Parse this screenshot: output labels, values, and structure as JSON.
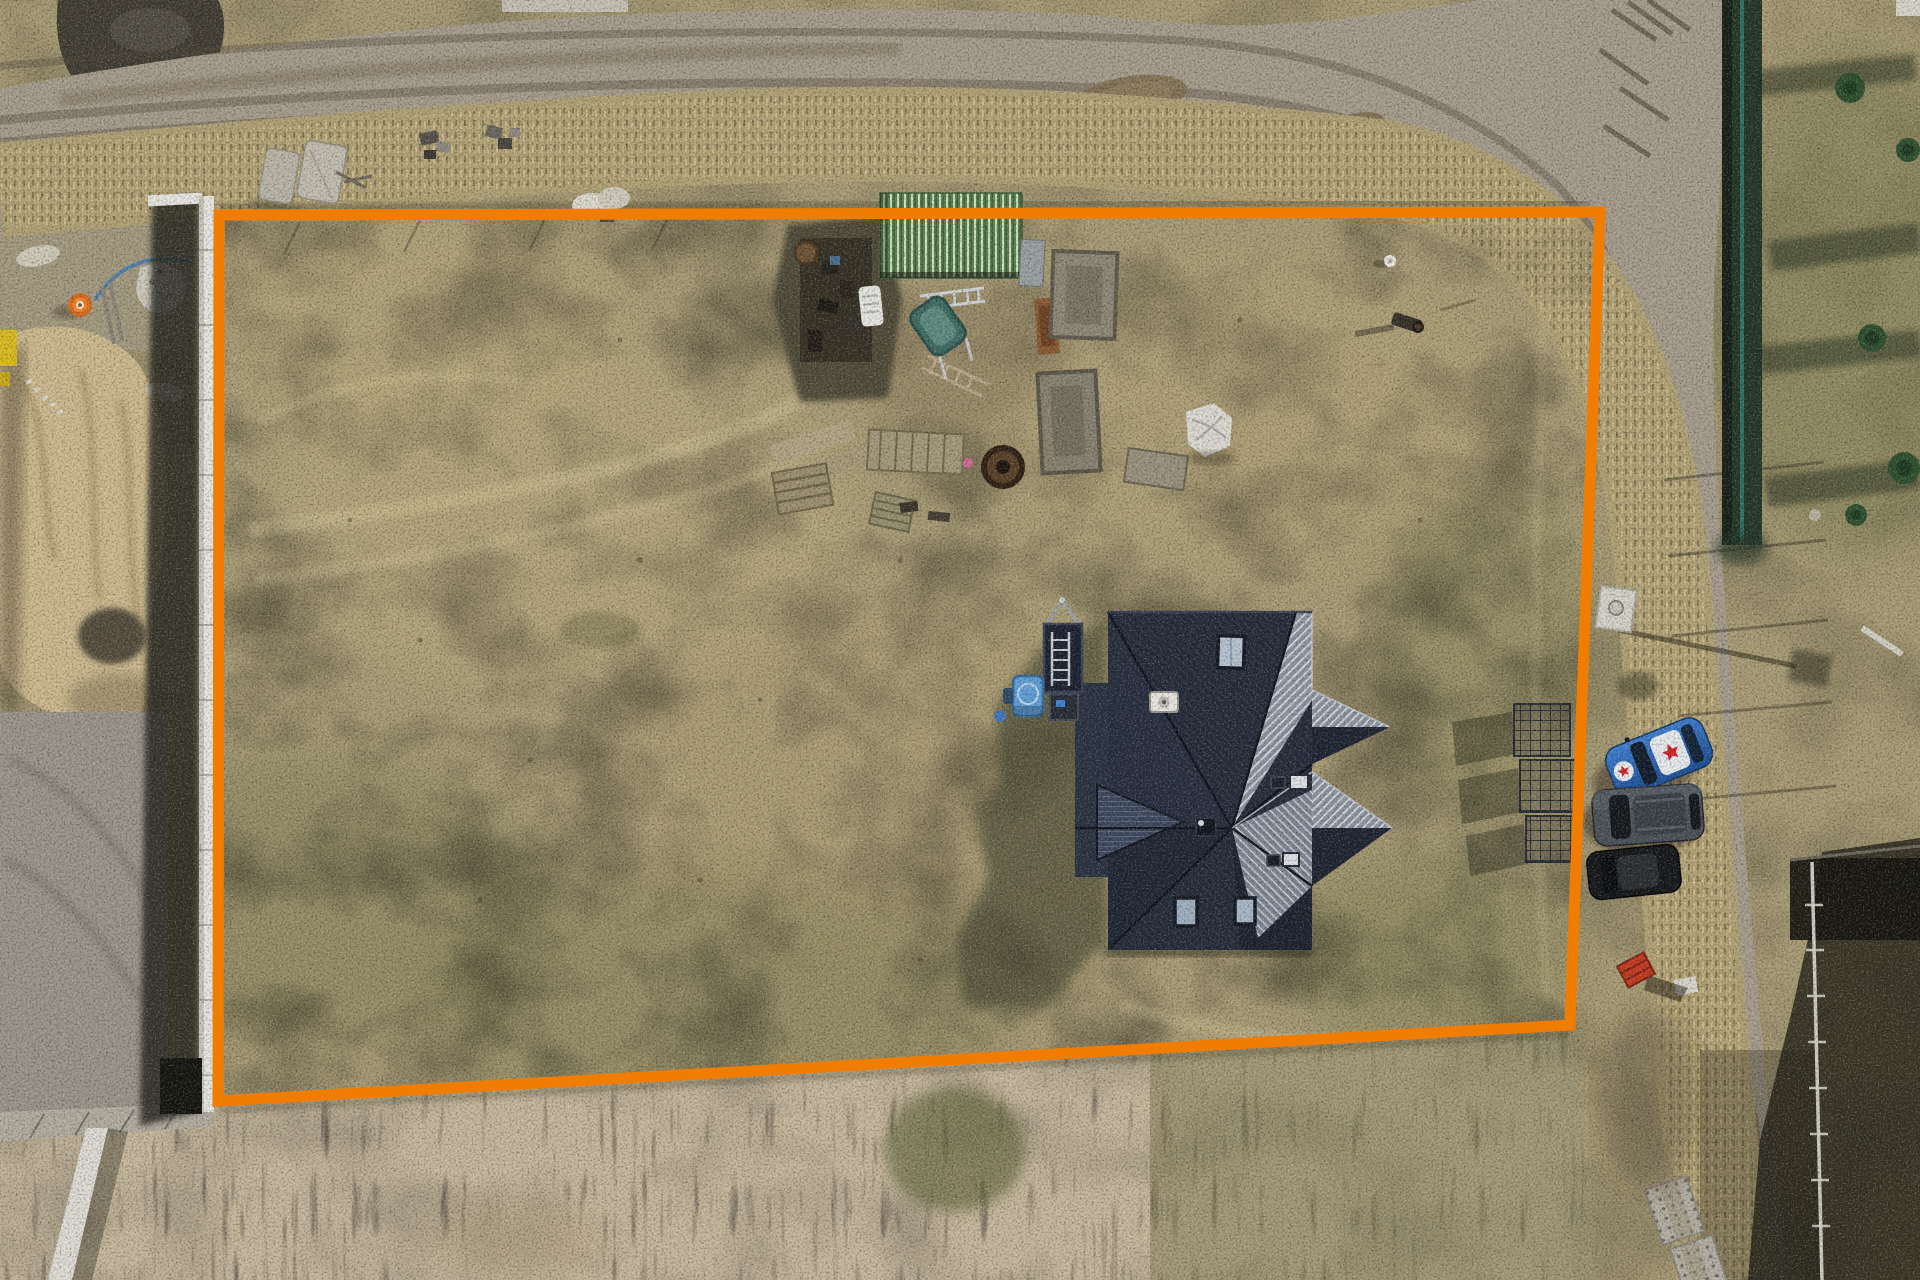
{
  "meta": {
    "title": "Aerial top-down drone photo of a building plot outlined in orange",
    "type": "aerial-drone-photograph",
    "view": "top-down"
  },
  "boundary": {
    "color": "#F07D00",
    "stroke_width_px": 11,
    "shape": "quadrilateral"
  },
  "colors": {
    "grass_tan": "#A89B74",
    "road_dirt": "#A69C8C",
    "pampas_grass": "#C6B79C",
    "sand_mound": "#CDB98E",
    "roof_dark": "#232938",
    "roof_light": "#99A1AD",
    "shed_roof_green": "#5A8350",
    "fence_white": "#E9E7E2"
  },
  "objects": {
    "house": {
      "name": "house-with-dark-hip-roof",
      "roof_style": "corrugated hip roof with skylights and chimneys",
      "skylights": 4,
      "chimneys": 2
    },
    "shed": {
      "name": "green-roof-site-shed",
      "roof_color": "#5A8350"
    },
    "trailer": {
      "name": "trailer-with-ladder",
      "color": "#1B2130"
    },
    "water_tank": {
      "name": "blue-water-tank",
      "color": "#5F9FD6"
    },
    "traffic_cone": {
      "name": "orange-traffic-cone",
      "color": "#F58220"
    },
    "wheelbarrow": {
      "name": "teal-wheelbarrow",
      "color": "#3F6B63"
    },
    "cars": [
      {
        "name": "car-blue-hatchback",
        "color": "#2E6FC4",
        "decals": "white roof panels with red stars"
      },
      {
        "name": "car-gray-suv",
        "color": "#4A5158"
      },
      {
        "name": "car-black",
        "color": "#141619"
      }
    ],
    "red_cart": {
      "name": "red-hand-cart",
      "color": "#C6391F"
    },
    "mesh_panels": {
      "name": "wire-mesh-panels",
      "count": 3
    },
    "white_fence": {
      "name": "white-fence-left-boundary",
      "color": "#E9E7E2"
    },
    "lamp_foundation": {
      "name": "street-lamp-foundation",
      "color": "#D6D3C9"
    },
    "concrete_slabs": {
      "name": "concrete-slab-pair-top-left"
    },
    "perforated_slabs": {
      "name": "perforated-road-slabs-bottom-right"
    },
    "sand_mound": {
      "name": "sand-mound-left"
    },
    "gravel_pile": {
      "name": "dark-gravel-pile-top-left"
    },
    "hedge": {
      "name": "dark-green-hedge-fence",
      "color": "#233627"
    },
    "conifers": {
      "name": "conifer-trees-right",
      "count": 5
    },
    "pampas": {
      "name": "tall-dry-grass-strip-bottom"
    }
  },
  "roads": [
    {
      "name": "dirt-road-top"
    },
    {
      "name": "dirt-road-right"
    }
  ]
}
